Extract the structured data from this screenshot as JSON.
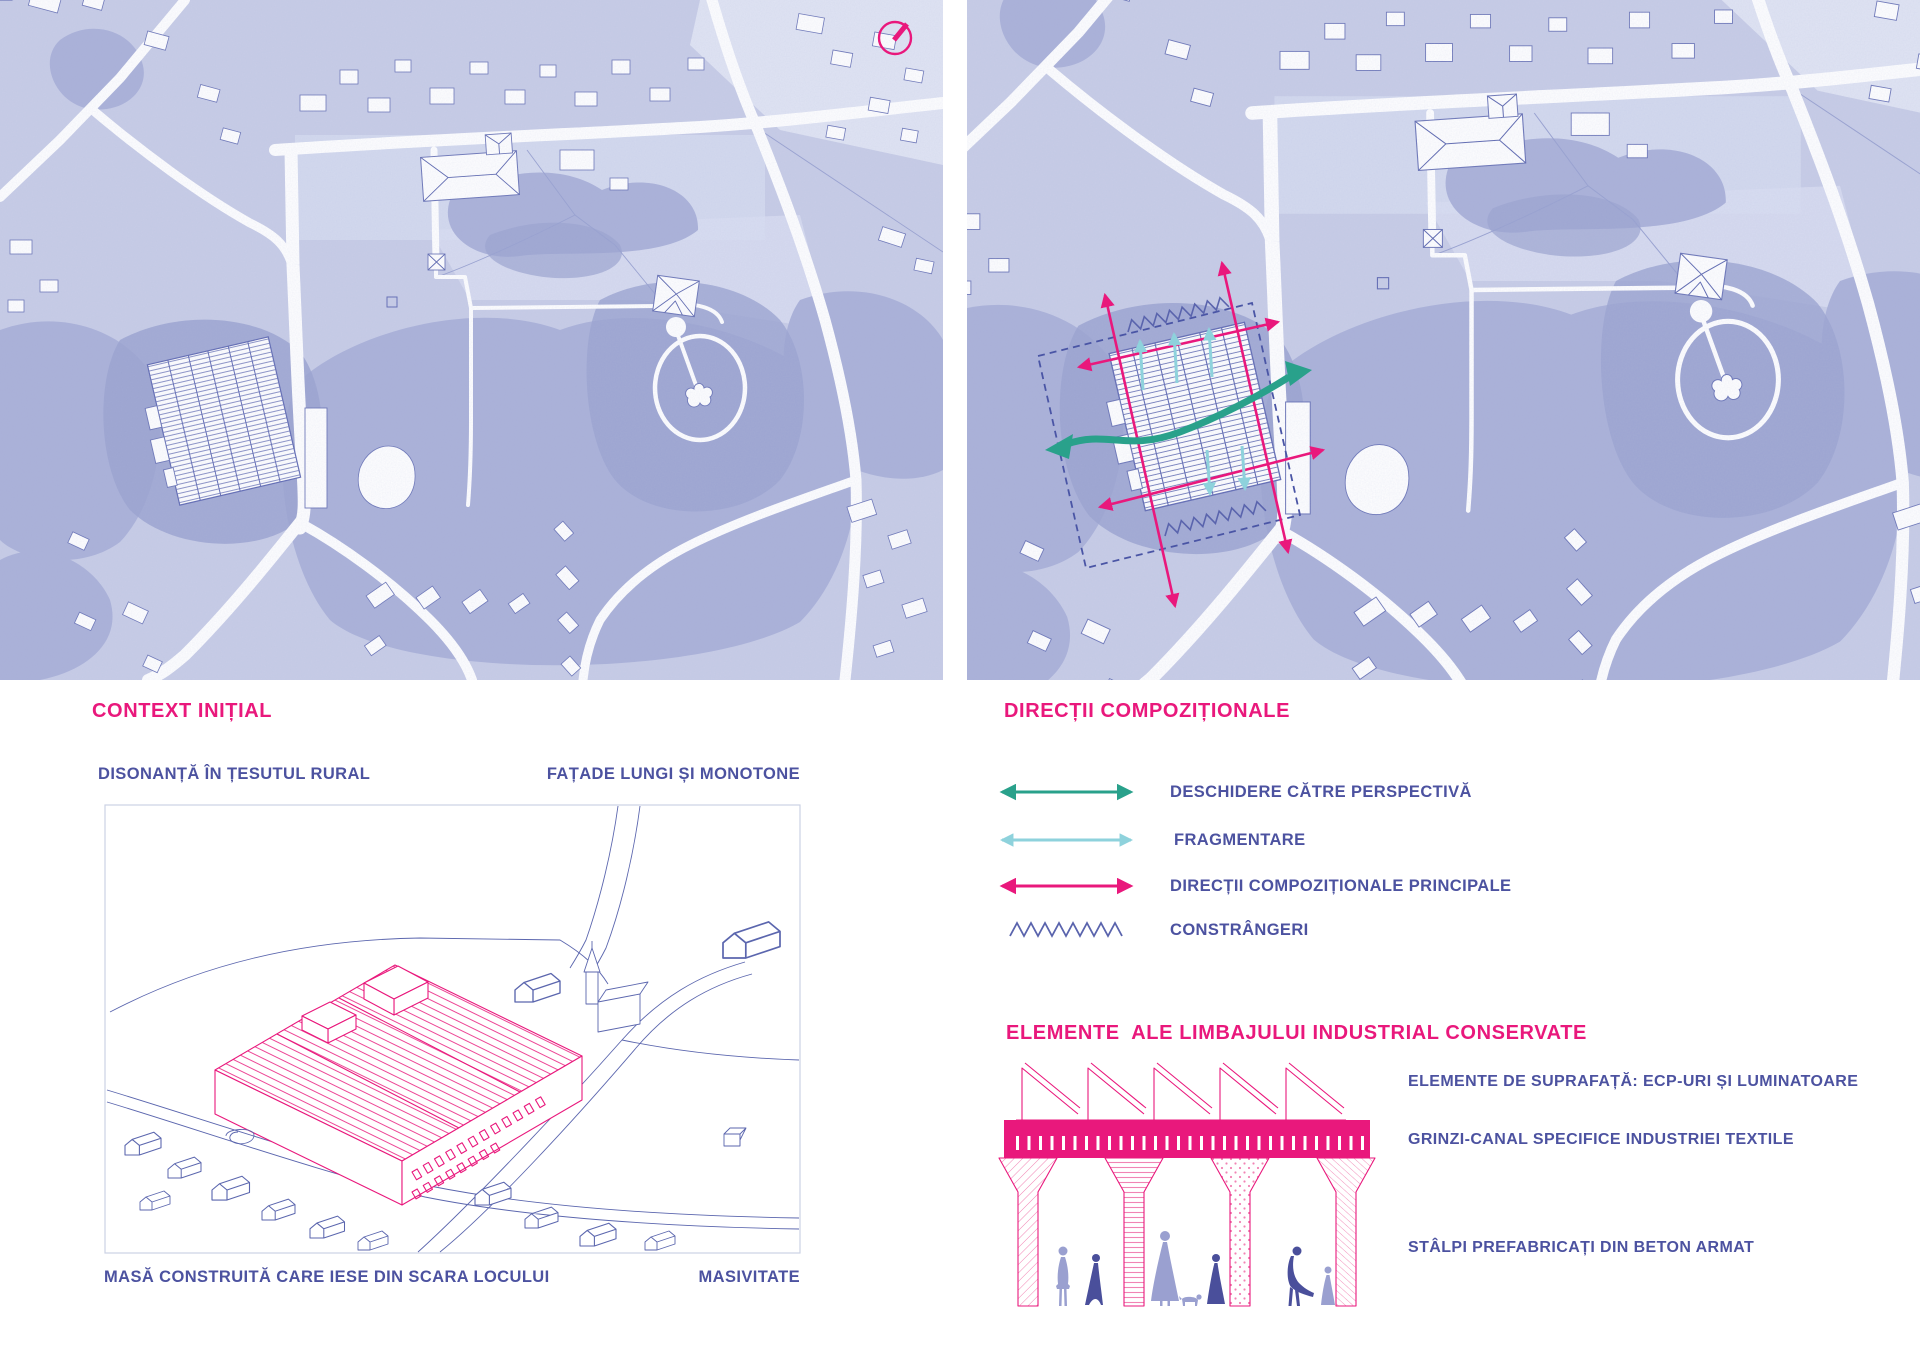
{
  "board": {
    "type": "architecture-analysis-board",
    "language": "Romanian"
  },
  "colors": {
    "accent-pink": "#e9187c",
    "label-purple": "#4c52a0",
    "teal": "#29a18b",
    "cyan": "#8ed2dc",
    "indigo": "#5a64ad",
    "map-base": "#c7cce6",
    "map-line": "#6a74b6",
    "fig-light": "#9aa0d0",
    "fig-dark": "#4a4f9b"
  },
  "maps": {
    "left": {
      "name": "site-map-initial",
      "compass": "north-arrow"
    },
    "right": {
      "name": "site-map-compositional-directions"
    }
  },
  "context_panel": {
    "title": "CONTEXT INIȚIAL",
    "label_top_left": "DISONANȚĂ ÎN ȚESUTUL RURAL",
    "label_top_right": "FAȚADE LUNGI ȘI MONOTONE",
    "label_bottom_left": "MASĂ CONSTRUITĂ CARE IESE DIN SCARA LOCULUI",
    "label_bottom_right": "MASIVITATE"
  },
  "directions_panel": {
    "title": "DIRECȚII COMPOZIȚIONALE",
    "legend": [
      {
        "symbol": "double-arrow",
        "color": "#29a18b",
        "label": "DESCHIDERE CĂTRE PERSPECTIVĂ"
      },
      {
        "symbol": "double-arrow",
        "color": "#8ed2dc",
        "label": "FRAGMENTARE"
      },
      {
        "symbol": "double-arrow",
        "color": "#e9187c",
        "label": "DIRECȚII COMPOZIȚIONALE PRINCIPALE"
      },
      {
        "symbol": "zigzag",
        "color": "#5a64ad",
        "label": "CONSTRÂNGERI"
      }
    ]
  },
  "elements_panel": {
    "title": "ELEMENTE  ALE LIMBAJULUI INDUSTRIAL CONSERVATE",
    "labels": [
      "ELEMENTE DE SUPRAFAȚĂ: ECP-URI ȘI LUMINATOARE",
      "GRINZI-CANAL SPECIFICE INDUSTRIEI TEXTILE",
      "STÂLPI PREFABRICAȚI DIN BETON ARMAT"
    ]
  }
}
